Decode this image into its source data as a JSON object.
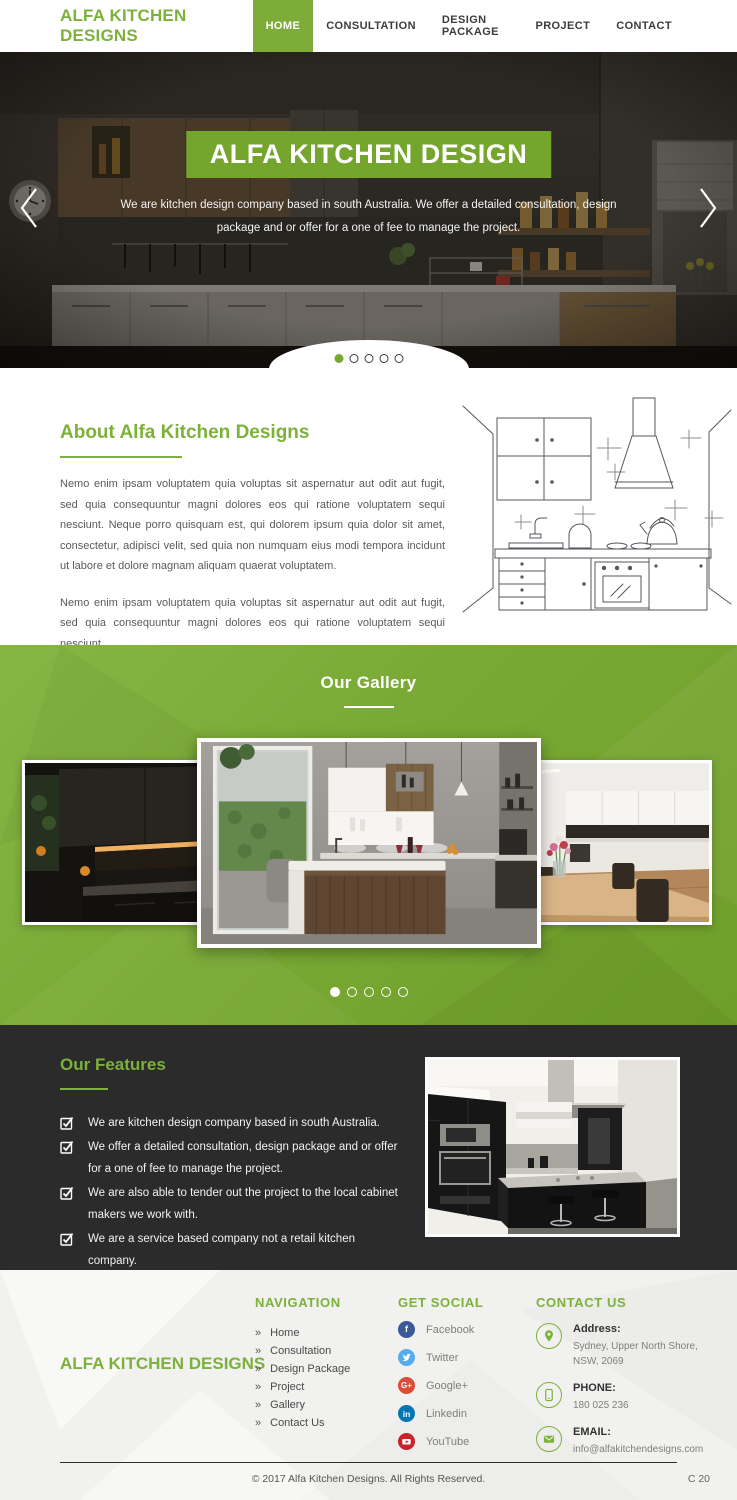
{
  "brand": {
    "name": "ALFA KITCHEN DESIGNS"
  },
  "nav": {
    "items": [
      {
        "label": "HOME",
        "active": true
      },
      {
        "label": "CONSULTATION",
        "active": false
      },
      {
        "label": "DESIGN PACKAGE",
        "active": false
      },
      {
        "label": "PROJECT",
        "active": false
      },
      {
        "label": "CONTACT",
        "active": false
      }
    ]
  },
  "hero": {
    "title": "ALFA KITCHEN DESIGN",
    "subtitle": "We are kitchen design company based in south Australia. We offer a detailed consultation, design package and or offer for a one of fee to manage the project.",
    "slide_count": 5,
    "active_slide": 1
  },
  "about": {
    "title": "About Alfa Kitchen Designs",
    "paragraphs": [
      "Nemo enim ipsam voluptatem quia voluptas sit aspernatur aut odit aut fugit, sed quia consequuntur magni dolores eos qui ratione voluptatem sequi nesciunt. Neque porro quisquam est, qui dolorem ipsum quia dolor sit amet, consectetur, adipisci velit, sed quia non numquam eius modi tempora incidunt ut labore et dolore magnam aliquam quaerat voluptatem.",
      "Nemo enim ipsam voluptatem quia voluptas sit aspernatur aut odit aut fugit, sed quia consequuntur magni dolores eos qui ratione voluptatem sequi nesciunt."
    ],
    "button_label": "Read More"
  },
  "gallery": {
    "title": "Our Gallery",
    "slide_count": 5,
    "active_slide": 1
  },
  "features": {
    "title": "Our Features",
    "items": [
      "We are kitchen design company based in south Australia.",
      "We offer a detailed consultation, design package and or offer for a one of fee to manage the project.",
      "We are also able to tender out the project to the local cabinet makers we work with.",
      "We are a service based company not a retail kitchen company."
    ]
  },
  "footer": {
    "brand": "ALFA KITCHEN DESIGNS",
    "navigation": {
      "title": "NAVIGATION",
      "items": [
        "Home",
        "Consultation",
        "Design Package",
        "Project",
        "Gallery",
        "Contact Us"
      ]
    },
    "social": {
      "title": "GET SOCIAL",
      "items": [
        {
          "label": "Facebook",
          "color": "#3b5998"
        },
        {
          "label": "Twitter",
          "color": "#55acee"
        },
        {
          "label": "Google+",
          "color": "#dd4b39"
        },
        {
          "label": "Linkedin",
          "color": "#0077b5"
        },
        {
          "label": "YouTube",
          "color": "#cc2127"
        }
      ]
    },
    "contact": {
      "title": "CONTACT US",
      "items": [
        {
          "label": "Address:",
          "value": "Sydney, Upper North Shore, NSW, 2069"
        },
        {
          "label": "PHONE:",
          "value": "180 025 236"
        },
        {
          "label": "EMAIL:",
          "value": "info@alfakitchendesigns.com"
        }
      ]
    },
    "copyright": "© 2017 Alfa Kitchen Designs. All Rights Reserved.",
    "version": "C 20"
  },
  "colors": {
    "accent_green": "#76a832",
    "heading_green": "#7cb13a",
    "banner_green": "#74a52d",
    "dark_section": "#2b2b2b",
    "footer_bg": "#f1f1ef"
  }
}
